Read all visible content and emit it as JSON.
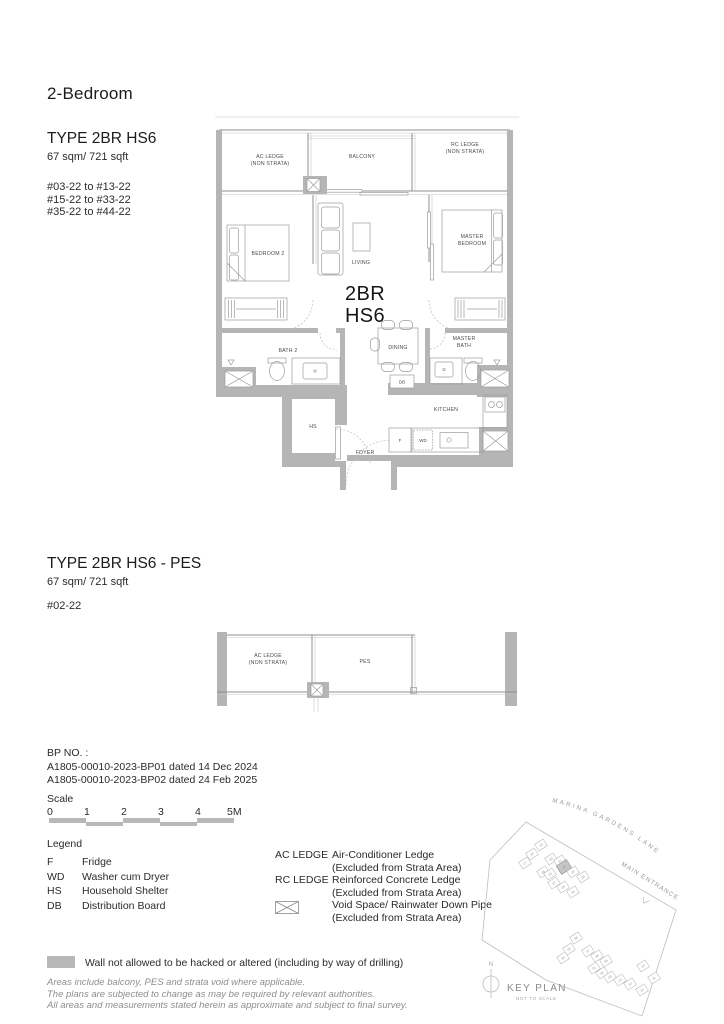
{
  "page": {
    "heading": "2-Bedroom"
  },
  "unit1": {
    "type_title": "TYPE 2BR HS6",
    "area": "67 sqm/ 721 sqft",
    "stacks": [
      "#03-22 to #13-22",
      "#15-22 to #33-22",
      "#35-22 to #44-22"
    ],
    "plan_code_line1": "2BR",
    "plan_code_line2": "HS6",
    "rooms": {
      "ac_ledge_1": "AC LEDGE",
      "ac_ledge_2": "(NON STRATA)",
      "balcony": "BALCONY",
      "rc_ledge_1": "RC LEDGE",
      "rc_ledge_2": "(NON STRATA)",
      "bedroom2": "BEDROOM 2",
      "living": "LIVING",
      "master_1": "MASTER",
      "master_2": "BEDROOM",
      "bath2": "BATH 2",
      "dining": "DINING",
      "master_bath_1": "MASTER",
      "master_bath_2": "BATH",
      "db": "DB",
      "hs": "HS",
      "foyer": "FOYER",
      "kitchen": "KITCHEN",
      "fridge": "F",
      "wd": "WD"
    }
  },
  "unit2": {
    "type_title": "TYPE 2BR HS6 - PES",
    "area": "67 sqm/ 721 sqft",
    "stacks": [
      "#02-22"
    ],
    "rooms": {
      "ac_ledge_1": "AC LEDGE",
      "ac_ledge_2": "(NON STRATA)",
      "pes": "PES"
    }
  },
  "bp": {
    "label": "BP NO. :",
    "lines": [
      "A1805-00010-2023-BP01 dated 14 Dec 2024",
      "A1805-00010-2023-BP02 dated 24 Feb 2025"
    ]
  },
  "scale": {
    "label": "Scale",
    "ticks": [
      "0",
      "1",
      "2",
      "3",
      "4",
      "5M"
    ]
  },
  "legend": {
    "title": "Legend",
    "items": [
      {
        "key": "F",
        "desc": "Fridge"
      },
      {
        "key": "WD",
        "desc": "Washer cum Dryer"
      },
      {
        "key": "HS",
        "desc": "Household Shelter"
      },
      {
        "key": "DB",
        "desc": "Distribution Board"
      }
    ],
    "items2": [
      {
        "key": "AC LEDGE",
        "desc1": "Air-Conditioner Ledge",
        "desc2": "(Excluded from Strata Area)"
      },
      {
        "key": "RC LEDGE",
        "desc1": "Reinforced Concrete Ledge",
        "desc2": "(Excluded from Strata Area)"
      },
      {
        "key": "void-symbol",
        "desc1": "Void Space/ Rainwater Down Pipe",
        "desc2": "(Excluded from Strata Area)"
      }
    ],
    "hack_note": "Wall not allowed to be hacked or altered (including by way of drilling)"
  },
  "disclaimer": [
    "Areas include balcony, PES and strata void where applicable.",
    "The plans are subjected to change as may be required by relevant authorities.",
    "All areas and measurements stated herein as approximate and subject to final survey."
  ],
  "keyplan": {
    "street": "MARINA GARDENS LANE",
    "entrance": "MAIN ENTRANCE",
    "title": "KEY PLAN",
    "subtitle": "NOT TO SCALE",
    "north": "N",
    "highlight_unit": "22",
    "cluster1": [
      "19",
      "18",
      "17",
      "20",
      "21",
      "16",
      "15",
      "23",
      "24",
      "27",
      "26",
      "25"
    ],
    "cluster2": [
      "06",
      "05",
      "04",
      "07",
      "08",
      "09",
      "01",
      "02",
      "03",
      "10",
      "11",
      "14",
      "13",
      "12"
    ]
  },
  "colors": {
    "wall_grey": "#b5b5b5",
    "scalebar_grey": "#b8b8b8",
    "text_dark": "#1c1c1c",
    "muted_grey": "#8e8e8e"
  }
}
